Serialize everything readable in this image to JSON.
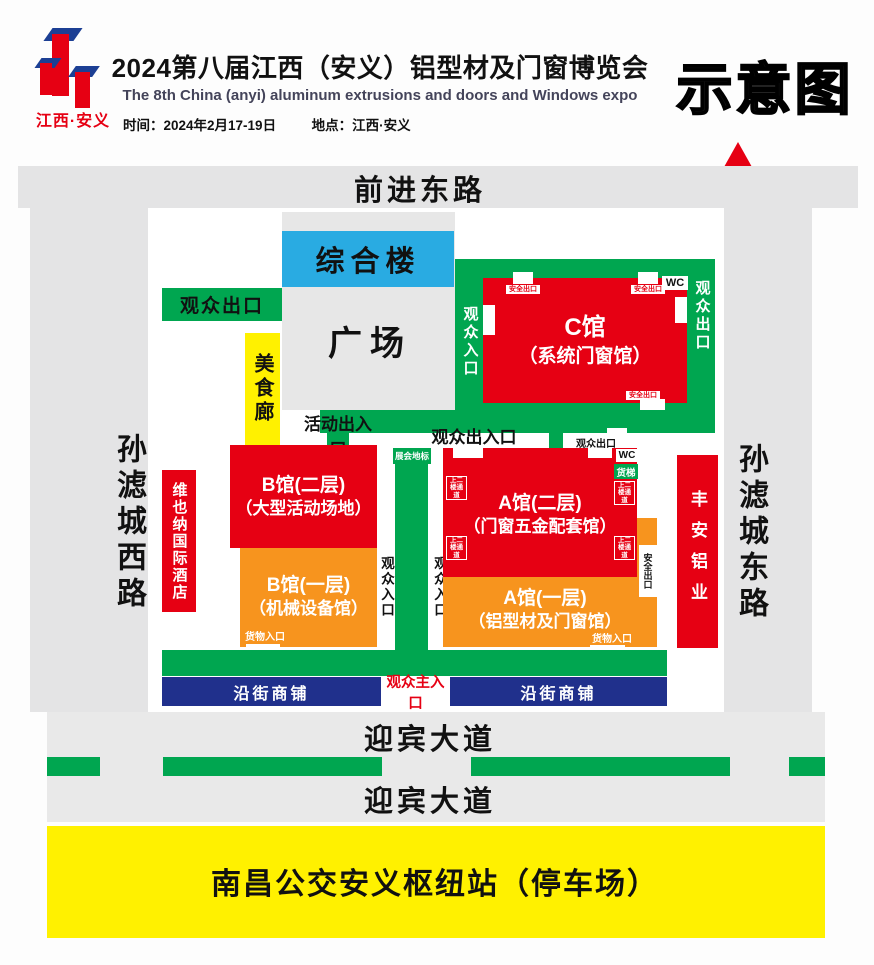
{
  "header": {
    "logo_name": "江西·安义",
    "title": "2024第八届江西（安义）铝型材及门窗博览会",
    "subtitle": "The 8th China (anyi) aluminum extrusions and doors and Windows expo",
    "time_label": "时间：",
    "time_value": "2024年2月17-19日",
    "place_label": "地点：",
    "place_value": "江西·安义",
    "schematic_tag": "示意图",
    "north": "北"
  },
  "roads": {
    "north_road": "前进东路",
    "west_road": "孙滤城西路",
    "east_road": "孙滤城东路",
    "avenue": "迎宾大道",
    "parking": "南昌公交安义枢纽站（停车场）"
  },
  "venue": {
    "complex": "综合楼",
    "plaza": "广场",
    "exit_nw": "观众出口",
    "food_corridor": "美食廊",
    "hall_c_line1": "C馆",
    "hall_c_line2": "（系统门窗馆）",
    "c_left_entry": "观众入口",
    "c_right_exit": "观众出口",
    "wc": "WC",
    "safety_exit": "安全出口",
    "activity_gate": "活动出入口",
    "visitor_gate": "观众出入口",
    "visitor_exit_small": "观众出口",
    "landmark": "展会地标",
    "hall_b2_line1": "B馆(二层)",
    "hall_b2_line2": "（大型活动场地）",
    "hall_b1_line1": "B馆(一层)",
    "hall_b1_line2": "（机械设备馆）",
    "hall_a2_line1": "A馆(二层)",
    "hall_a2_line2": "（门窗五金配套馆）",
    "hall_a1_line1": "A馆(一层)",
    "hall_a1_line2": "（铝型材及门窗馆）",
    "freight_lift": "货梯",
    "stairs_passage": "上二楼通道",
    "central_entry": "观众入口",
    "hotel": "维也纳国际酒店",
    "fengan_aluminum": "丰安铝业",
    "goods_entry": "货物入口",
    "street_shops": "沿街商铺",
    "main_entry": "观众主入口"
  },
  "colors": {
    "green": "#00a650",
    "red": "#e60013",
    "orange": "#f7941e",
    "complex_blue": "#29abe2",
    "shops_navy": "#20308c",
    "yellow": "#fff100",
    "road_gray": "#e4e4e5"
  }
}
